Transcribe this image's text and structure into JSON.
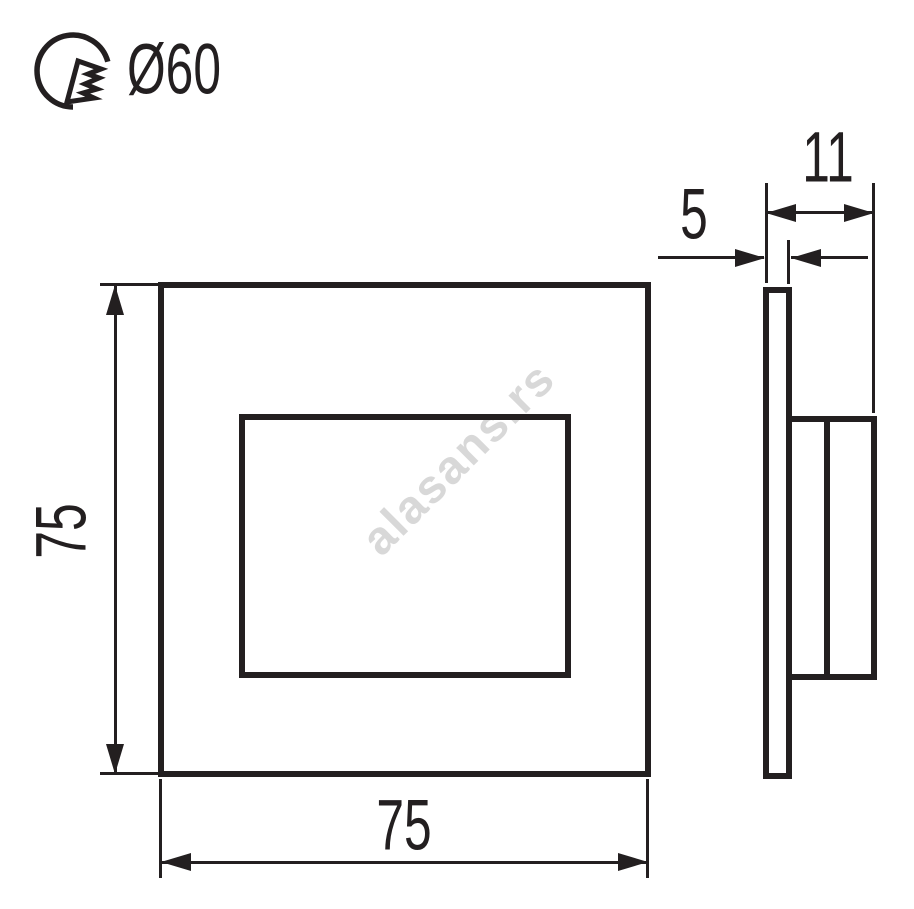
{
  "page": {
    "background": "#ffffff",
    "line_color": "#231f20"
  },
  "cutout": {
    "icon": "hole-saw-icon",
    "label": "Ø60"
  },
  "front_view": {
    "width_label": "75",
    "height_label": "75"
  },
  "side_view": {
    "total_depth_label": "11",
    "plate_thickness_label": "5"
  },
  "watermark": {
    "text": "alasans.rs",
    "color": "#d8d8d8",
    "angle_deg": -45
  }
}
